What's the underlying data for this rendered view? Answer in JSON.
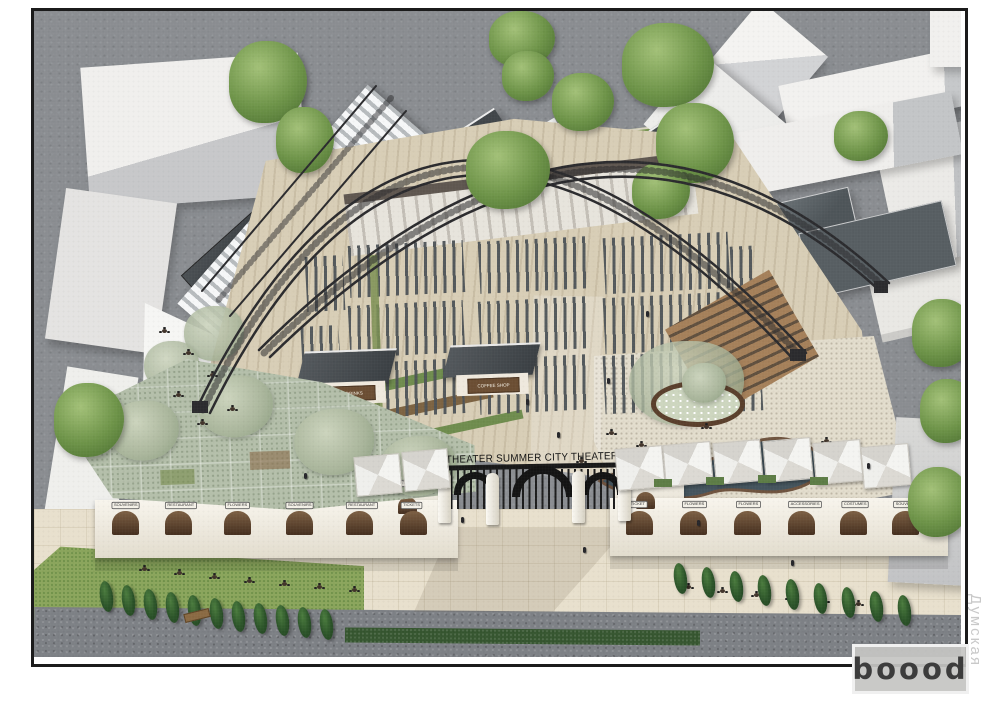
{
  "banner": {
    "text": "THEATER SUMMER CITY THEATER"
  },
  "gate": {
    "left_sign": "TICKETS",
    "right_sign": "TICKETS"
  },
  "left_arcade": {
    "signs": [
      "SOUVENIRS",
      "RESTAURANT",
      "FLOWERS",
      "SOUVENIRS",
      "RESTAURANT",
      "TICKETS"
    ]
  },
  "right_arcade": {
    "signs": [
      "TICKET",
      "FLOWERS",
      "FLOWERS",
      "ACCESSORIES",
      "COSTUMES",
      "SOUVENIR"
    ]
  },
  "kiosks": {
    "left": "MR. DRINKS",
    "right": "COFFEE SHOP"
  },
  "watermarks": {
    "studio": "boood",
    "site": "Думская"
  },
  "palette": {
    "frame": "#1b1b1b",
    "paper": "#ffffff",
    "street": "#8a8d91",
    "plaza": "#e8e0cd",
    "wood_floor": "#d8ceb6",
    "bench": "#4d5357",
    "lawn": "#7a9751",
    "olive_canopy": "#b4bfaa",
    "pond": "#3f505a",
    "dark_roof": "#4e5559",
    "truss": "#2b2b2e",
    "umbrella": "#f2f2ef",
    "castle_red": "#b5392f",
    "castle_blue": "#3f6fa8",
    "castle_yellow": "#e2b637"
  }
}
